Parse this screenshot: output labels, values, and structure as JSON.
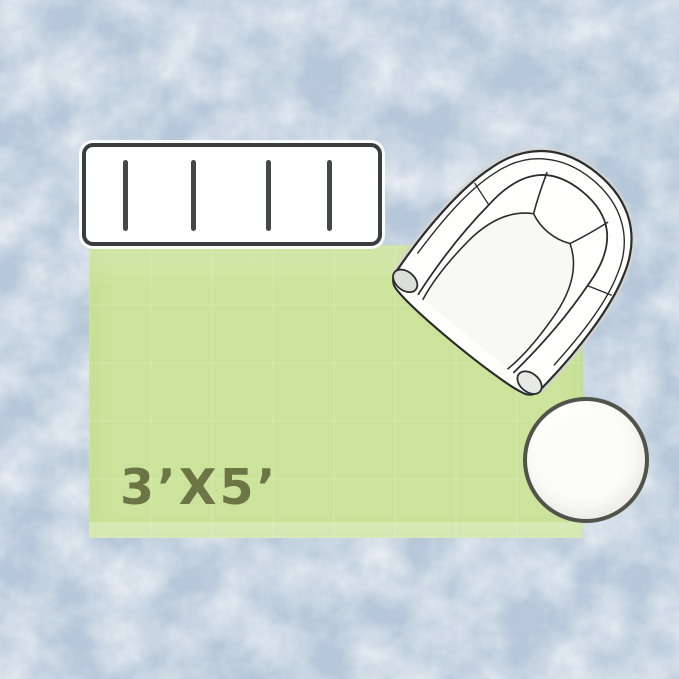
{
  "background": {
    "color": "#b6c7d9",
    "texture": "mottled-paper"
  },
  "rug": {
    "size_label": "3’X5’",
    "color": "#cbe39a",
    "label_color": "#6d7547",
    "width_feet": 5,
    "height_feet": 3
  },
  "furniture": {
    "console_table": {
      "icon": "console-table-top-view-icon",
      "slat_count": 4,
      "fill": "#ffffff",
      "outline": "#3b3e41"
    },
    "armchair": {
      "icon": "armchair-top-view-icon",
      "fill": "#fefefc",
      "outline": "#2a2c2d"
    },
    "side_table": {
      "icon": "round-side-table-top-view-icon",
      "fill": "#fdfdf8",
      "outline": "#50544a"
    }
  }
}
